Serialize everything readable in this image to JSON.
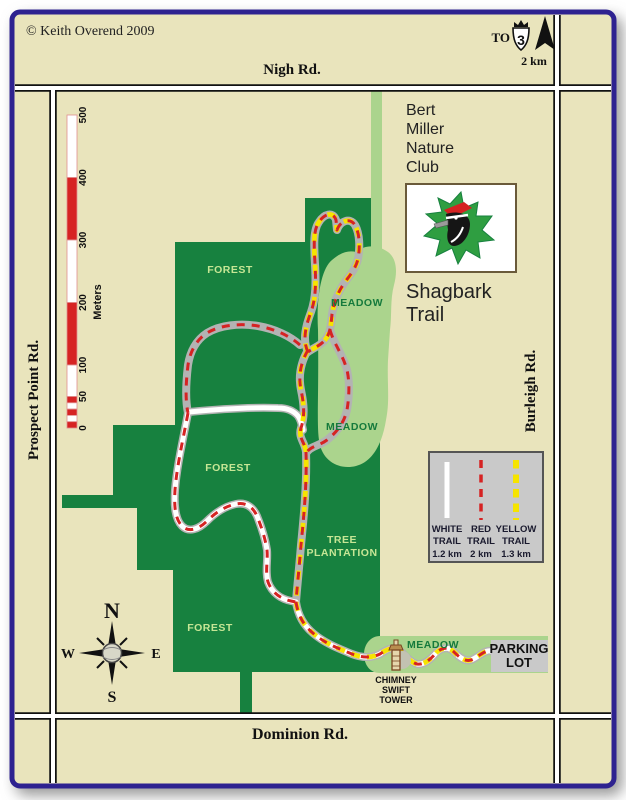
{
  "map": {
    "copyright": "© Keith Overend 2009",
    "title": {
      "club_lines": [
        "Bert",
        "Miller",
        "Nature",
        "Club"
      ],
      "trail_lines": [
        "Shagbark",
        "Trail"
      ]
    },
    "roads": {
      "north": "Nigh Rd.",
      "south": "Dominion Rd.",
      "west": "Prospect Point Rd.",
      "east": "Burleigh Rd."
    },
    "highway": {
      "to_label": "TO",
      "number": "3",
      "distance": "2 km"
    },
    "scale": {
      "ticks": [
        "0",
        "50",
        "100",
        "200",
        "300",
        "400",
        "500"
      ],
      "unit": "Meters"
    },
    "compass": {
      "north": "N",
      "east": "E",
      "south": "S",
      "west": "W"
    },
    "areas": {
      "forest_labels": [
        "FOREST",
        "FOREST",
        "FOREST"
      ],
      "meadow_labels": [
        "MEADOW",
        "MEADOW",
        "MEADOW"
      ],
      "plantation_lines": [
        "TREE",
        "PLANTATION"
      ]
    },
    "poi": {
      "tower_lines": [
        "CHIMNEY",
        "SWIFT",
        "TOWER"
      ],
      "parking_lines": [
        "PARKING",
        "LOT"
      ]
    },
    "legend": {
      "items": [
        {
          "line1": "WHITE",
          "line2": "TRAIL",
          "distance": "1.2 km"
        },
        {
          "line1": "RED",
          "line2": "TRAIL",
          "distance": "2 km"
        },
        {
          "line1": "YELLOW",
          "line2": "TRAIL",
          "distance": "1.3 km"
        }
      ]
    },
    "colors": {
      "background": "#e9e4bc",
      "border": "#2e2290",
      "forest": "#17813f",
      "meadow": "#abd48d",
      "road_casing": "#111111",
      "road_fill": "#ffffff",
      "trail_white": "#ffffff",
      "trail_red": "#d62323",
      "trail_yellow": "#f6e400",
      "trail_casing": "#b3b3b3",
      "legend_bg": "#c9c9c9",
      "parking_bg": "#c9c9c9",
      "label_forest": "#c6e695",
      "label_meadow": "#157a3c"
    }
  }
}
